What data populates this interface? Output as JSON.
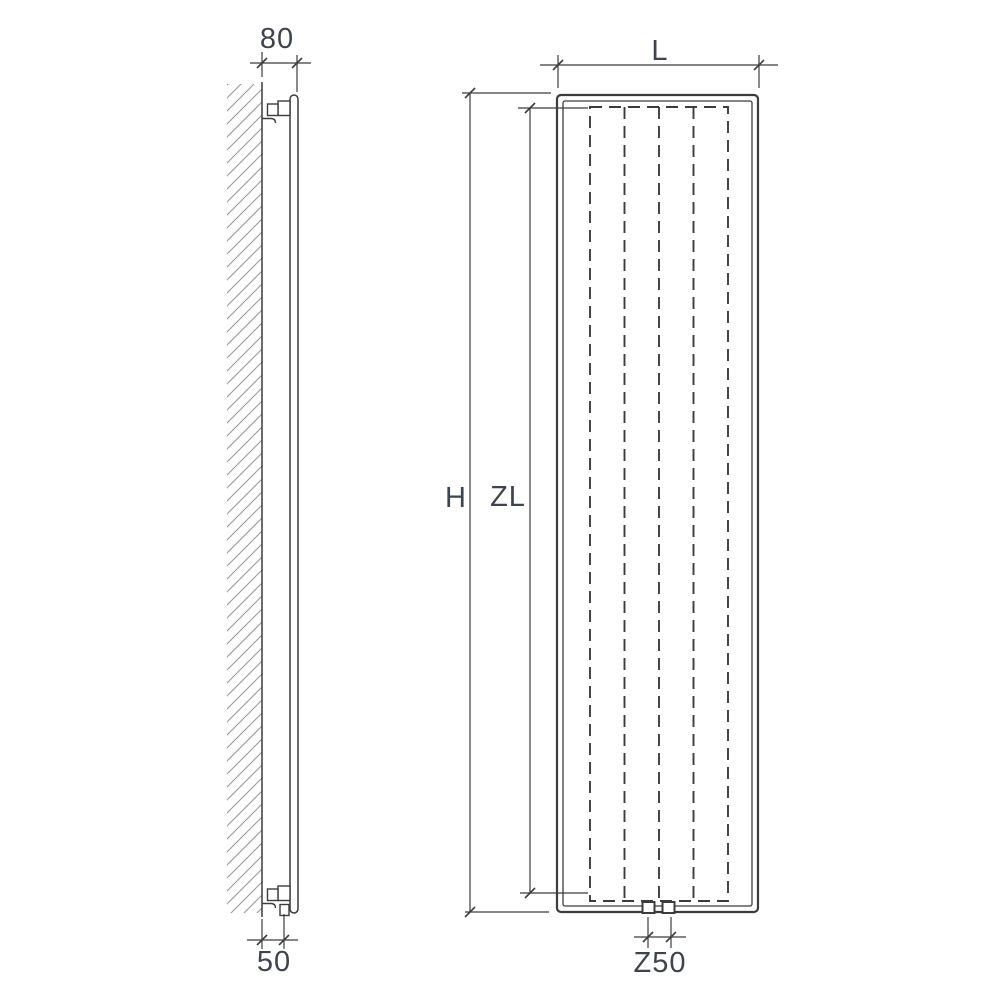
{
  "diagram": {
    "type": "technical-dimension-drawing",
    "subject": "vertical panel radiator, wall-mounted: side section view and front view"
  },
  "labels": {
    "depth": "80",
    "bottom_offset": "50",
    "width": "L",
    "height": "H",
    "convector_height": "ZL",
    "connection_spacing": "Z50"
  },
  "colors": {
    "background": "#ffffff",
    "line": "#3c3c3c",
    "hatch": "#9a9a9a",
    "dimension_text": "#3e4350"
  }
}
